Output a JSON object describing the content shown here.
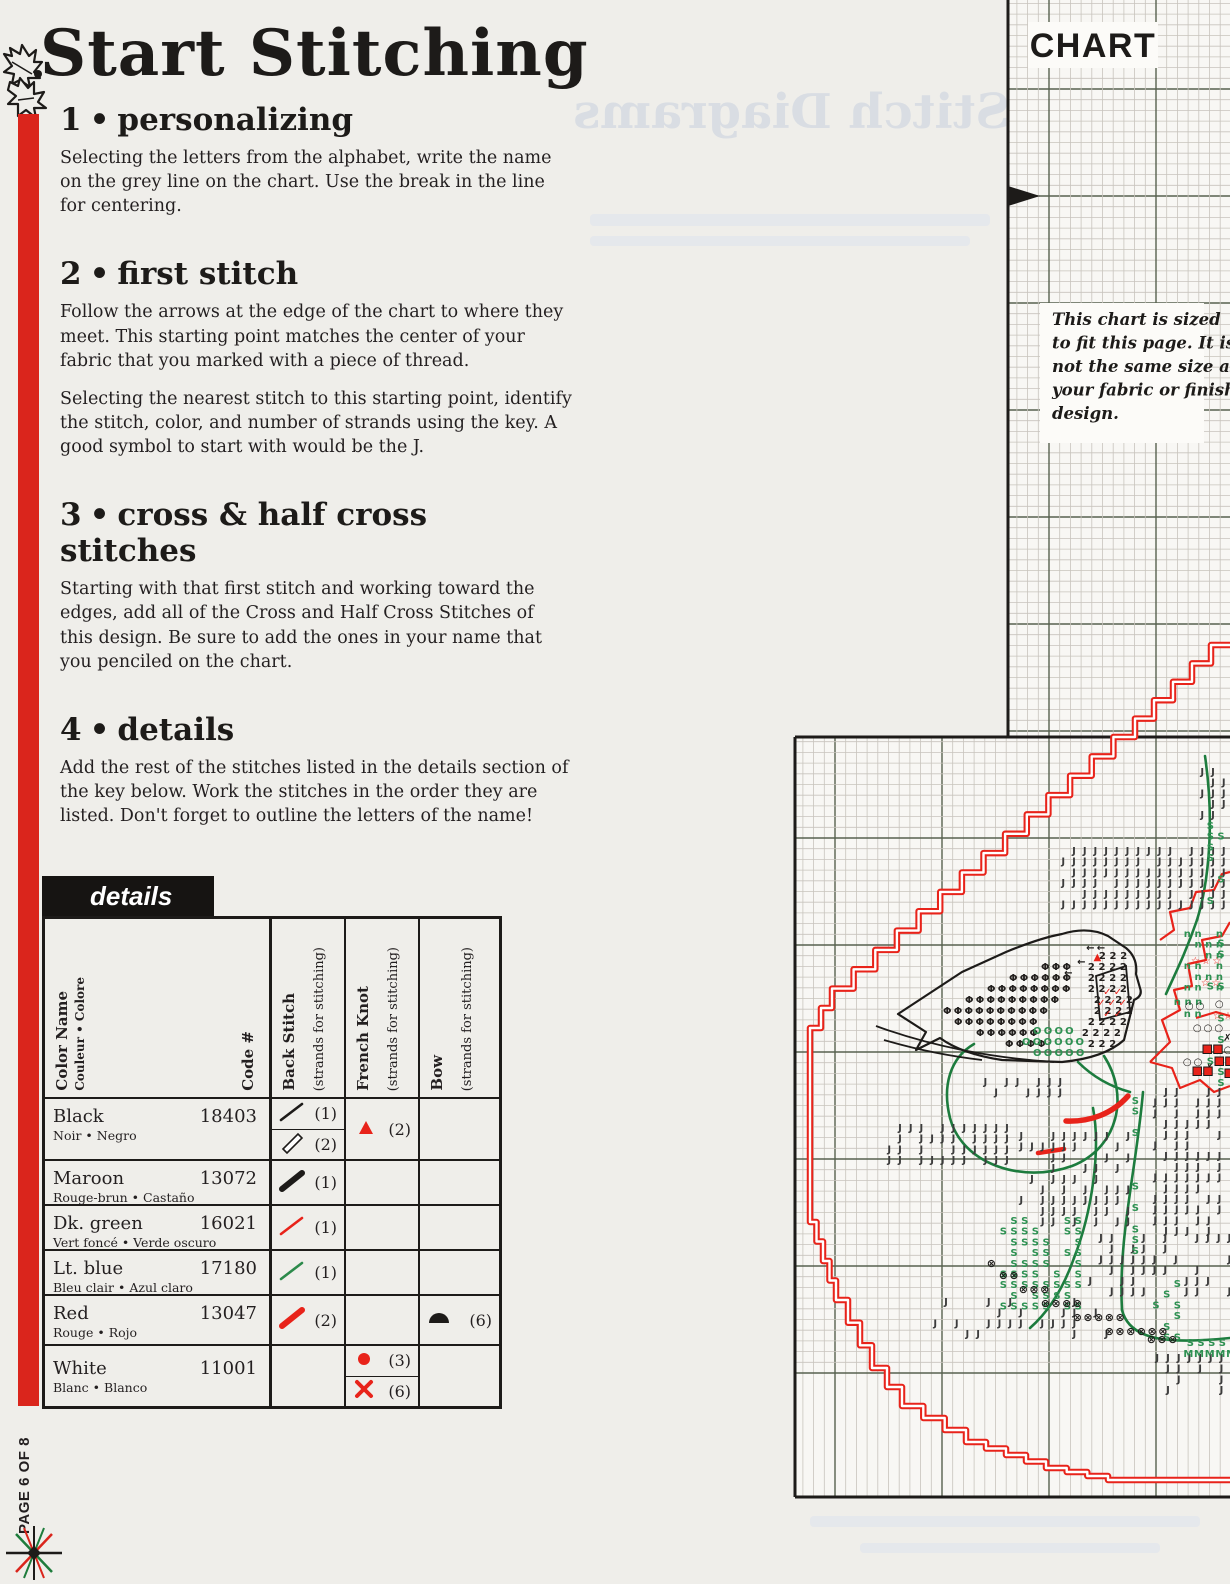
{
  "page": {
    "title": "Start Stitching",
    "page_indicator": "PAGE 6 OF 8",
    "accent_red": "#da251c",
    "ghost_title": "Stitch Diagrams"
  },
  "sections": [
    {
      "num": "1",
      "bullet": "•",
      "heading": "personalizing",
      "p1": "Selecting the letters from the alphabet, write the name on the grey line on the chart. Use the break in the line for centering."
    },
    {
      "num": "2",
      "bullet": "•",
      "heading": "first stitch",
      "p1": "Follow the arrows at the edge of the chart to where they meet. This starting point matches the center of your fabric that you marked with a piece of thread.",
      "p2": "Selecting the nearest stitch to this starting point, identify the stitch, color, and number of strands using the key. A good symbol to start with would be the J."
    },
    {
      "num": "3",
      "bullet": "•",
      "heading": "cross & half cross stitches",
      "p1": "Starting with that first stitch and working toward the edges, add all of the Cross and Half Cross Stitches of this design. Be sure to add the ones in your name that you penciled on the chart."
    },
    {
      "num": "4",
      "bullet": "•",
      "heading": "details",
      "p1": "Add the rest of the stitches listed in the details section of the key below. Work the stitches in the order they are listed. Don't forget to outline the letters of the name!"
    }
  ],
  "details_table": {
    "title": "details",
    "headers": {
      "color_name": "Color Name",
      "color_name_sub": "Couleur • Colore",
      "code": "Code #",
      "back_stitch": "Back Stitch",
      "strands": "(strands for stitching)",
      "french_knot": "French Knot",
      "bow": "Bow"
    },
    "rows": [
      {
        "name": "Black",
        "sub": "Noir • Negro",
        "code": "18403",
        "back_stitch": [
          {
            "symbol": "thin-line",
            "color": "#1d1b19",
            "strands": "(1)"
          },
          {
            "symbol": "outline-line",
            "color": "#1d1b19",
            "strands": "(2)"
          }
        ],
        "french_knot": [
          {
            "symbol": "triangle",
            "color": "#e8231a",
            "strands": "(2)"
          }
        ]
      },
      {
        "name": "Maroon",
        "sub": "Rouge-brun • Castaño",
        "code": "13072",
        "back_stitch": [
          {
            "symbol": "thick-line",
            "color": "#1d1b19",
            "strands": "(1)"
          }
        ]
      },
      {
        "name": "Dk. green",
        "sub": "Vert foncé • Verde oscuro",
        "code": "16021",
        "back_stitch": [
          {
            "symbol": "thin-line",
            "color": "#e8231a",
            "strands": "(1)"
          }
        ]
      },
      {
        "name": "Lt. blue",
        "sub": "Bleu clair • Azul claro",
        "code": "17180",
        "back_stitch": [
          {
            "symbol": "thin-line",
            "color": "#2c8a4b",
            "strands": "(1)"
          }
        ]
      },
      {
        "name": "Red",
        "sub": "Rouge • Rojo",
        "code": "13047",
        "back_stitch": [
          {
            "symbol": "thick-line",
            "color": "#e8231a",
            "strands": "(2)"
          }
        ],
        "bow": [
          {
            "symbol": "half-dome",
            "color": "#1d1b19",
            "strands": "(6)"
          }
        ]
      },
      {
        "name": "White",
        "sub": "Blanc • Blanco",
        "code": "11001",
        "french_knot": [
          {
            "symbol": "dot",
            "color": "#e8231a",
            "strands": "(3)"
          },
          {
            "symbol": "x",
            "color": "#e8231a",
            "strands": "(6)"
          }
        ]
      }
    ]
  },
  "chart": {
    "label": "CHART",
    "note_lines": [
      "This chart is sized",
      "to fit this page. It is",
      "not the same size as",
      "your fabric or finished",
      "design."
    ],
    "bg": "#f8f7f4",
    "grid_fine": "#c8c4bd",
    "grid_heavy": "#57614f",
    "border": "#1d1b19",
    "red": "#e8231a",
    "green_stem": "#1d7c3e",
    "green_sym": "#2e9152",
    "dark_sym": "#3c3c3c",
    "cell": 10.7,
    "heavy_origin": {
      "x": 835,
      "y": 89
    },
    "regions": [
      {
        "x": 1008,
        "y": 0,
        "w": 222,
        "h": 737
      },
      {
        "x": 795,
        "y": 737,
        "w": 435,
        "h": 760
      }
    ],
    "borders": [
      [
        1008,
        0,
        1008,
        737
      ],
      [
        795,
        737,
        1230,
        737
      ],
      [
        795,
        737,
        795,
        1497
      ],
      [
        795,
        1497,
        1230,
        1497
      ]
    ],
    "arrow": {
      "x": 1008,
      "y": 196
    },
    "label_box": {
      "x": 1028,
      "y": 22,
      "w": 130,
      "h": 46
    },
    "note_box": {
      "x": 1040,
      "y": 303,
      "w": 164,
      "h": 140
    },
    "staircase": [
      [
        1230,
        645
      ],
      [
        1135,
        737
      ],
      [
        832,
        1008
      ],
      [
        810,
        1048
      ],
      [
        810,
        1222
      ],
      [
        836,
        1300
      ],
      [
        872,
        1368
      ],
      [
        902,
        1406
      ],
      [
        966,
        1442
      ],
      [
        1046,
        1468
      ],
      [
        1108,
        1480
      ],
      [
        1230,
        1480
      ]
    ],
    "stems": [
      "M1205,756 C1214,818 1210,878 1197,920",
      "M1197,920 C1186,952 1176,972 1166,994",
      "M1143,1092 C1136,1172 1118,1238 1122,1310",
      "M1122,1310 C1130,1342 1172,1344 1230,1338",
      "M1093,1108 C1101,1150 1092,1212 1074,1258",
      "M1074,1258 C1062,1292 1046,1314 1030,1328",
      "M1078,1062 C1092,1076 1108,1086 1130,1092"
    ],
    "wreath": "M1104,1056 C1130,1096 1118,1148 1072,1166 C1022,1184 962,1164 950,1118 C942,1086 950,1058 974,1044",
    "bird": {
      "outline": "M898,1014 L962,972 L1006,952 Q1040,938 1062,934 Q1088,926 1108,936 L1126,948 Q1138,958 1136,974 L1140,988 Q1143,996 1134,1000 L1124,1040 Q1104,1058 1062,1062 L1002,1060 Q962,1054 940,1038 L916,1050 L926,1032 Z",
      "wing": "M1096,976 L1126,966 L1130,1012 L1100,1020 Z",
      "branches": [
        "M876,1026 C930,1046 992,1058 1054,1062",
        "M884,1040 C918,1050 948,1056 982,1060"
      ]
    },
    "poinsettia": [
      "M1150,1062 L1170,1042 L1162,1020 L1180,1010 L1174,990 L1192,986 L1188,964 L1206,960 L1202,940 L1222,936 L1230,922",
      "M1150,1062 L1172,1068 L1180,1088 L1200,1080 L1214,1092 L1230,1086",
      "M1196,1018 L1216,1012 L1230,1016",
      "M1160,940 L1174,930 L1170,912 L1190,908 L1196,892 L1214,890 L1222,874 L1230,872"
    ],
    "red_swoosh": "M1128,1096 C1112,1114 1090,1122 1066,1121",
    "red_dash": "M1038,1153 L1064,1149",
    "clusters": [
      {
        "sym": "J",
        "color": "#3c3c3c",
        "type": "field",
        "x": 1058,
        "y": 845,
        "w": 172,
        "h": 64,
        "density": 0.93
      },
      {
        "sym": "J",
        "color": "#3c3c3c",
        "type": "field",
        "x": 884,
        "y": 1122,
        "w": 132,
        "h": 42,
        "density": 0.85
      },
      {
        "sym": "J",
        "color": "#3c3c3c",
        "type": "field",
        "x": 1150,
        "y": 1086,
        "w": 80,
        "h": 150,
        "density": 0.72
      },
      {
        "sym": "J",
        "color": "#3c3c3c",
        "type": "field",
        "x": 1016,
        "y": 1130,
        "w": 118,
        "h": 96,
        "density": 0.6
      },
      {
        "sym": "J",
        "color": "#3c3c3c",
        "type": "field",
        "x": 1085,
        "y": 1232,
        "w": 145,
        "h": 64,
        "density": 0.55
      },
      {
        "sym": "J",
        "color": "#3c3c3c",
        "type": "field",
        "x": 948,
        "y": 1076,
        "w": 120,
        "h": 20,
        "density": 0.5
      },
      {
        "sym": "J",
        "color": "#3c3c3c",
        "type": "field",
        "x": 1152,
        "y": 1352,
        "w": 78,
        "h": 38,
        "density": 0.7
      },
      {
        "sym": "J",
        "color": "#3c3c3c",
        "type": "field",
        "x": 1197,
        "y": 766,
        "w": 33,
        "h": 55,
        "density": 0.8
      },
      {
        "sym": "J",
        "color": "#3c3c3c",
        "type": "field",
        "x": 930,
        "y": 1296,
        "w": 180,
        "h": 40,
        "density": 0.5
      },
      {
        "sym": "S",
        "color": "#2e9152",
        "type": "field",
        "x": 1205,
        "y": 820,
        "w": 25,
        "h": 270,
        "density": 0.45
      },
      {
        "sym": "S",
        "color": "#2e9152",
        "type": "field",
        "x": 1130,
        "y": 1095,
        "w": 14,
        "h": 165,
        "density": 0.8
      },
      {
        "sym": "S",
        "color": "#2e9152",
        "type": "field",
        "x": 998,
        "y": 1215,
        "w": 82,
        "h": 100,
        "density": 0.75
      },
      {
        "sym": "S",
        "color": "#2e9152",
        "type": "field",
        "x": 1140,
        "y": 1278,
        "w": 42,
        "h": 62,
        "density": 0.6
      },
      {
        "sym": "S",
        "color": "#2e9152",
        "type": "rows",
        "rows": [
          [
            1185,
            1337,
            4
          ],
          [
            1228,
            1337,
            1
          ]
        ]
      },
      {
        "sym": "M",
        "color": "#2e9152",
        "type": "rows",
        "rows": [
          [
            1183,
            1348,
            5
          ]
        ]
      },
      {
        "sym": "Φ",
        "color": "#23201e",
        "type": "rows",
        "rows": [
          [
            1040,
            961,
            3
          ],
          [
            1008,
            972,
            6
          ],
          [
            986,
            983,
            8
          ],
          [
            964,
            994,
            9
          ],
          [
            942,
            1005,
            10
          ],
          [
            953,
            1016,
            8
          ],
          [
            975,
            1027,
            6
          ],
          [
            1004,
            1038,
            4
          ]
        ]
      },
      {
        "sym": "2",
        "color": "#23201e",
        "type": "rows",
        "rows": [
          [
            1097,
            950,
            3
          ],
          [
            1086,
            961,
            4
          ],
          [
            1086,
            972,
            4
          ],
          [
            1086,
            983,
            4
          ],
          [
            1092,
            994,
            4
          ],
          [
            1092,
            1005,
            4
          ],
          [
            1086,
            1016,
            4
          ],
          [
            1080,
            1027,
            4
          ],
          [
            1086,
            1038,
            3
          ]
        ]
      },
      {
        "sym": "O",
        "color": "#2e9152",
        "type": "rows",
        "rows": [
          [
            1032,
            1025,
            4
          ],
          [
            1021,
            1036,
            6
          ],
          [
            1032,
            1047,
            5
          ]
        ]
      },
      {
        "sym": "n",
        "color": "#2e9152",
        "type": "field",
        "x": 1182,
        "y": 928,
        "w": 48,
        "h": 64,
        "density": 0.8
      },
      {
        "sym": "n",
        "color": "#2e9152",
        "type": "rows",
        "rows": [
          [
            1172,
            996,
            3
          ],
          [
            1182,
            1008,
            2
          ]
        ]
      },
      {
        "sym": "☆",
        "color": "#e8231a",
        "type": "rows",
        "rows": [
          [
            1190,
            955,
            3
          ],
          [
            1200,
            977,
            2
          ],
          [
            1212,
            1010,
            2
          ]
        ]
      },
      {
        "sym": "○",
        "color": "#1d1b19",
        "type": "rows",
        "rows": [
          [
            1184,
            1000,
            2
          ],
          [
            1214,
            998,
            1
          ],
          [
            1192,
            1022,
            3
          ],
          [
            1212,
            1044,
            2
          ],
          [
            1182,
            1056,
            2
          ]
        ]
      },
      {
        "sym": "⊗",
        "color": "#1d1b19",
        "type": "rows",
        "rows": [
          [
            986,
            1258,
            1
          ],
          [
            998,
            1270,
            2
          ],
          [
            1018,
            1284,
            3
          ],
          [
            1040,
            1298,
            4
          ],
          [
            1072,
            1312,
            5
          ],
          [
            1104,
            1326,
            6
          ],
          [
            1146,
            1334,
            3
          ]
        ]
      },
      {
        "sym": "✗",
        "color": "#1d1b19",
        "type": "rows",
        "rows": [
          [
            1222,
            1032,
            1
          ],
          [
            1204,
            1062,
            1
          ]
        ]
      },
      {
        "sym": "✓",
        "color": "#e8231a",
        "type": "rows",
        "rows": [
          [
            1102,
            986,
            2
          ],
          [
            1096,
            997,
            3
          ],
          [
            1102,
            1008,
            2
          ]
        ]
      },
      {
        "sym": "←",
        "color": "#1d1b19",
        "type": "rows",
        "rows": [
          [
            1085,
            942,
            2
          ],
          [
            1076,
            956,
            1
          ],
          [
            1063,
            967,
            1
          ]
        ]
      },
      {
        "sym": "▲",
        "color": "#e8231a",
        "type": "rows",
        "rows": [
          [
            1092,
            951,
            1
          ]
        ]
      },
      {
        "sym": "■",
        "color": "#e8231a",
        "type": "rows",
        "rows": [
          [
            1202,
            1044,
            2
          ],
          [
            1214,
            1056,
            2
          ],
          [
            1192,
            1066,
            2
          ],
          [
            1224,
            1068,
            1
          ]
        ]
      }
    ]
  }
}
